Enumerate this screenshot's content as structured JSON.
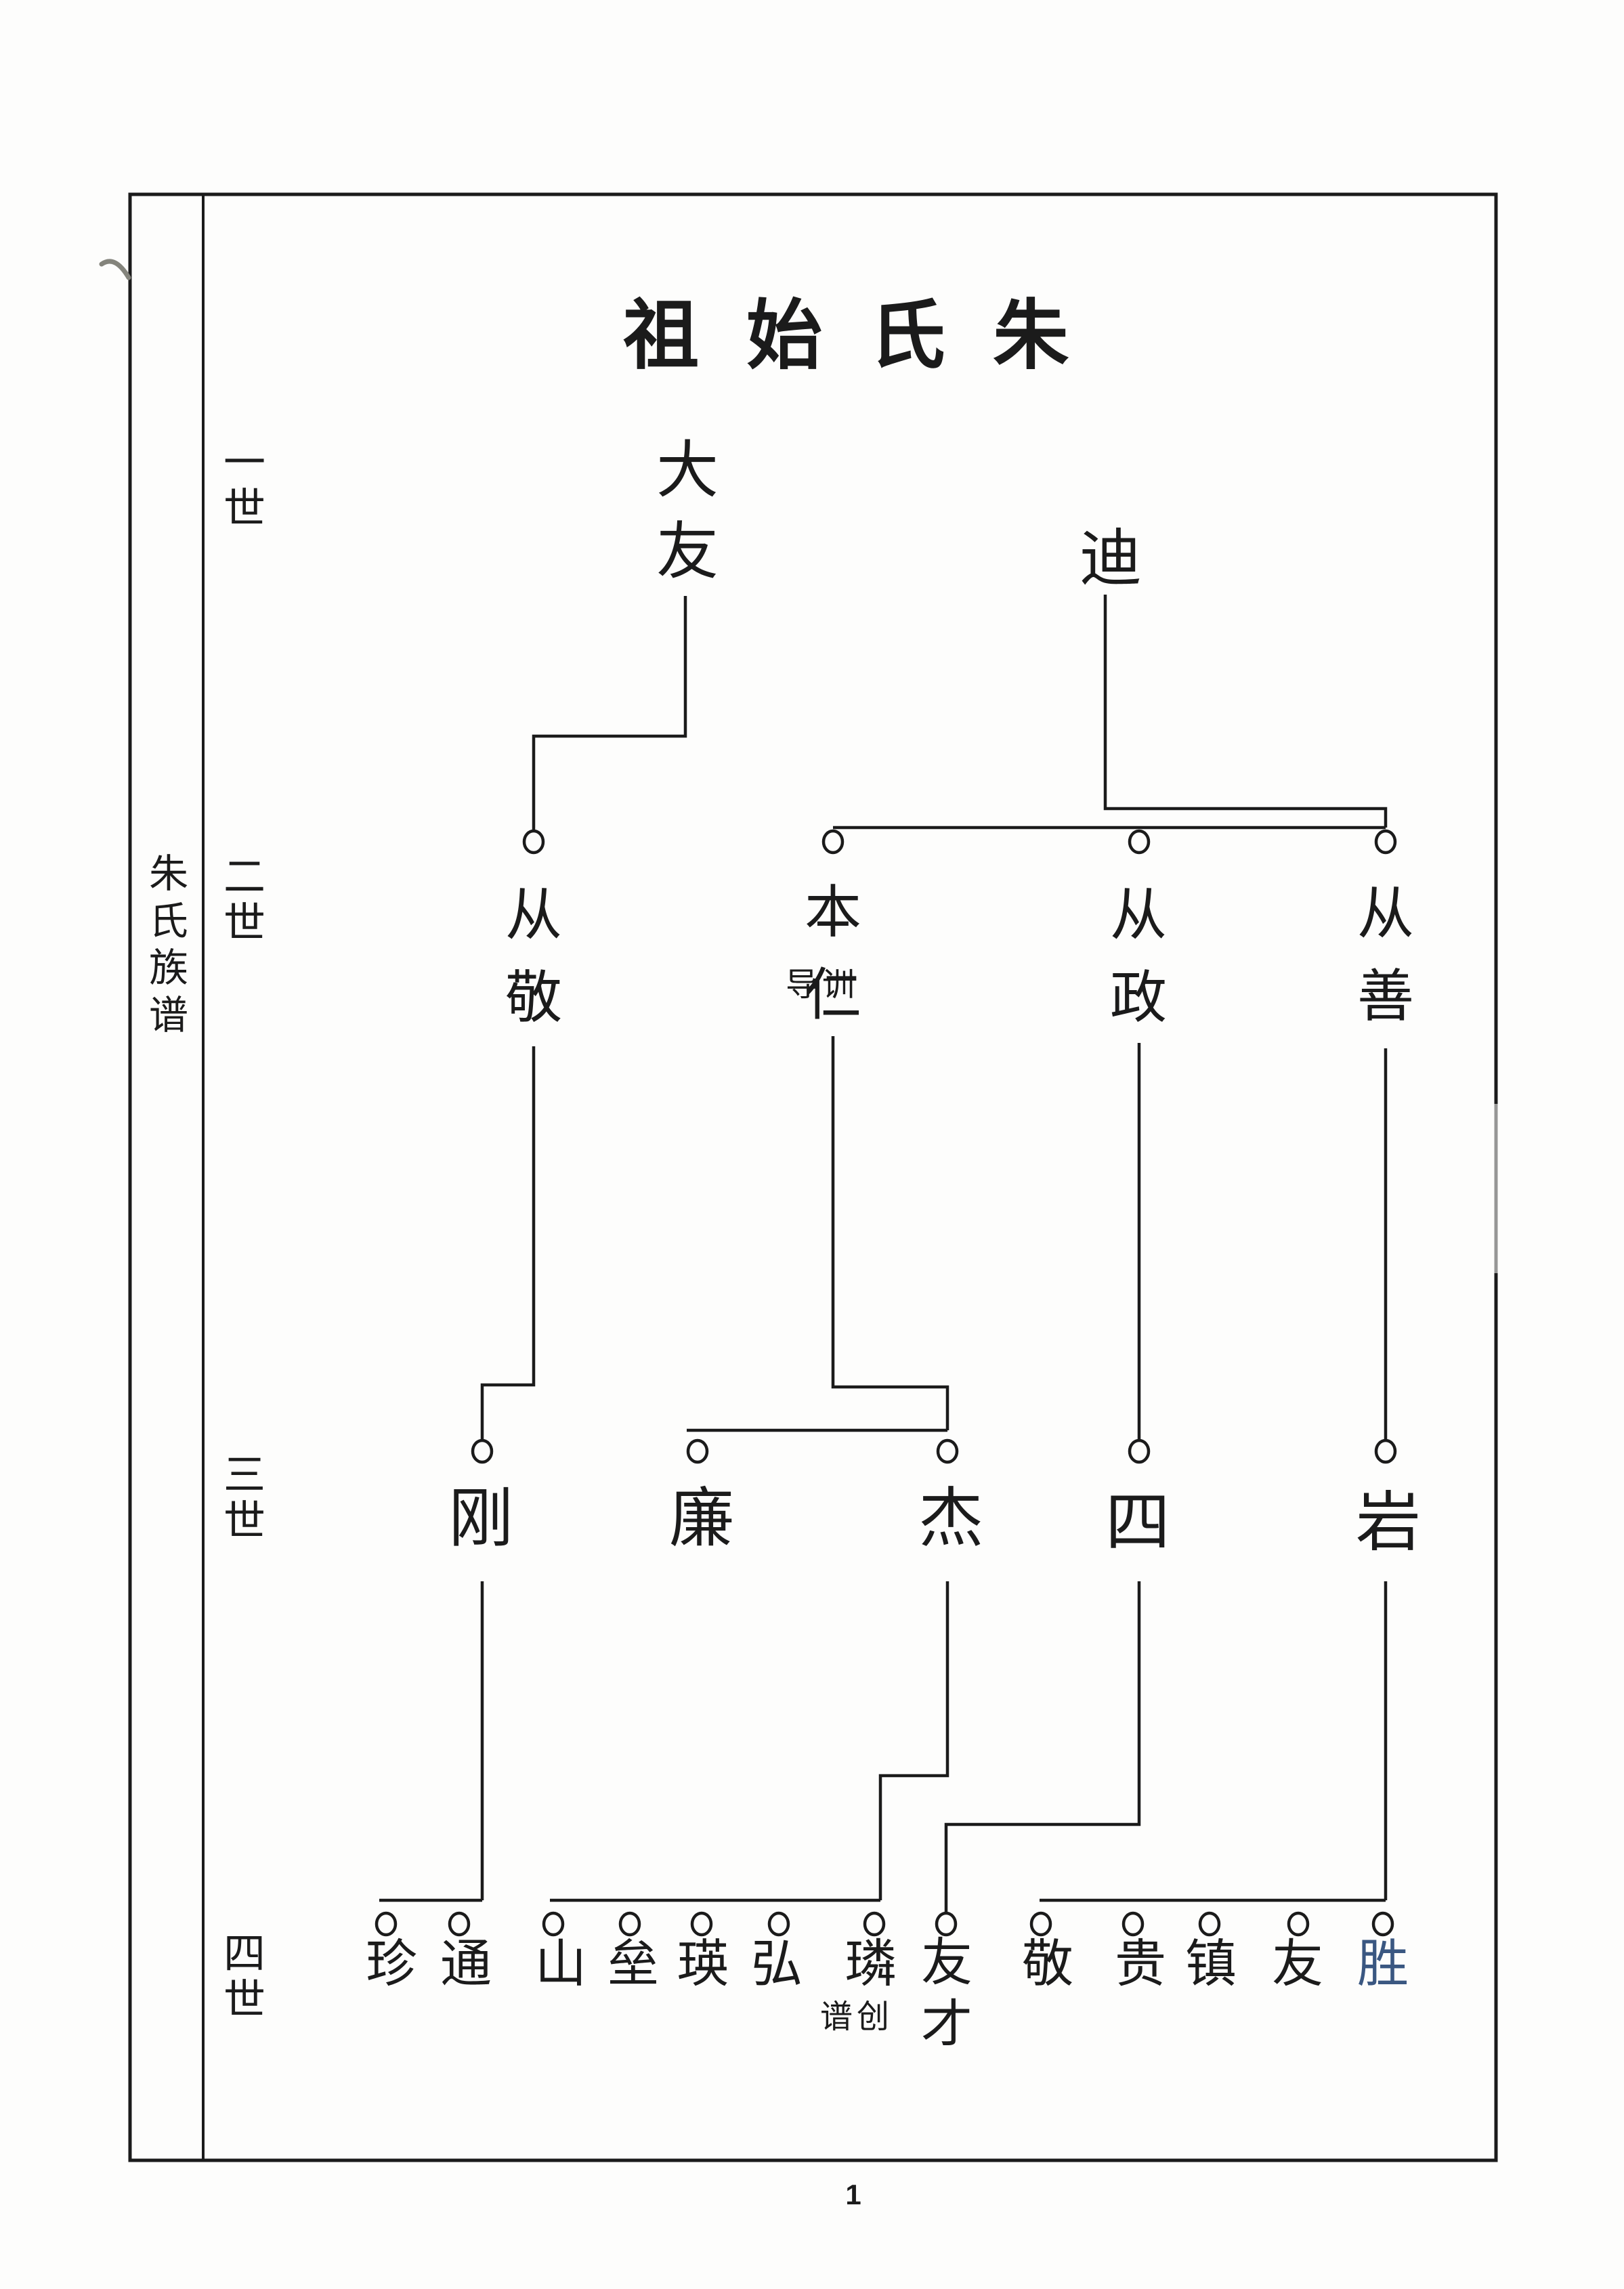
{
  "title": "祖始氏朱",
  "sidebar": {
    "label": "朱氏族谱"
  },
  "page": {
    "number": "1"
  },
  "colors": {
    "ink": "#1b1b1b",
    "highlight_blue": "#3a5781",
    "paper": "#fdfdfc",
    "pencil_mark": "#84847c"
  },
  "generations": [
    {
      "label": "一世",
      "people": [
        {
          "name": "大友"
        },
        {
          "name": "迪"
        }
      ]
    },
    {
      "label": "二世",
      "people": [
        {
          "name": "从敬"
        },
        {
          "name": "本仁",
          "annotation": "导训"
        },
        {
          "name": "从政"
        },
        {
          "name": "从善"
        }
      ]
    },
    {
      "label": "三世",
      "people": [
        {
          "name": "刚"
        },
        {
          "name": "廉"
        },
        {
          "name": "杰"
        },
        {
          "name": "四"
        },
        {
          "name": "岩"
        }
      ]
    },
    {
      "label": "四世",
      "people": [
        {
          "name": "珍"
        },
        {
          "name": "通"
        },
        {
          "name": "山"
        },
        {
          "name": "垒"
        },
        {
          "name": "瑛"
        },
        {
          "name": "弘"
        },
        {
          "name": "璘",
          "annotation": "谱创"
        },
        {
          "name": "友才"
        },
        {
          "name": "敬"
        },
        {
          "name": "贵"
        },
        {
          "name": "镇"
        },
        {
          "name": "友"
        },
        {
          "name": "胜",
          "highlighted": true
        }
      ]
    }
  ],
  "tree_edges": [
    {
      "parent": "大友",
      "children": [
        "从敬"
      ]
    },
    {
      "parent": "迪",
      "children": [
        "本仁",
        "从政",
        "从善"
      ]
    },
    {
      "parent": "从敬",
      "children": [
        "刚"
      ]
    },
    {
      "parent": "本仁",
      "children": [
        "廉",
        "杰"
      ]
    },
    {
      "parent": "从政",
      "children": [
        "四"
      ]
    },
    {
      "parent": "从善",
      "children": [
        "岩"
      ]
    },
    {
      "parent": "刚",
      "children": [
        "珍",
        "通"
      ]
    },
    {
      "parent": "杰",
      "children": [
        "山",
        "垒",
        "瑛",
        "弘",
        "璘"
      ]
    },
    {
      "parent": "四",
      "children": [
        "友才"
      ]
    },
    {
      "parent": "岩",
      "children": [
        "敬",
        "贵",
        "镇",
        "友",
        "胜"
      ]
    }
  ]
}
